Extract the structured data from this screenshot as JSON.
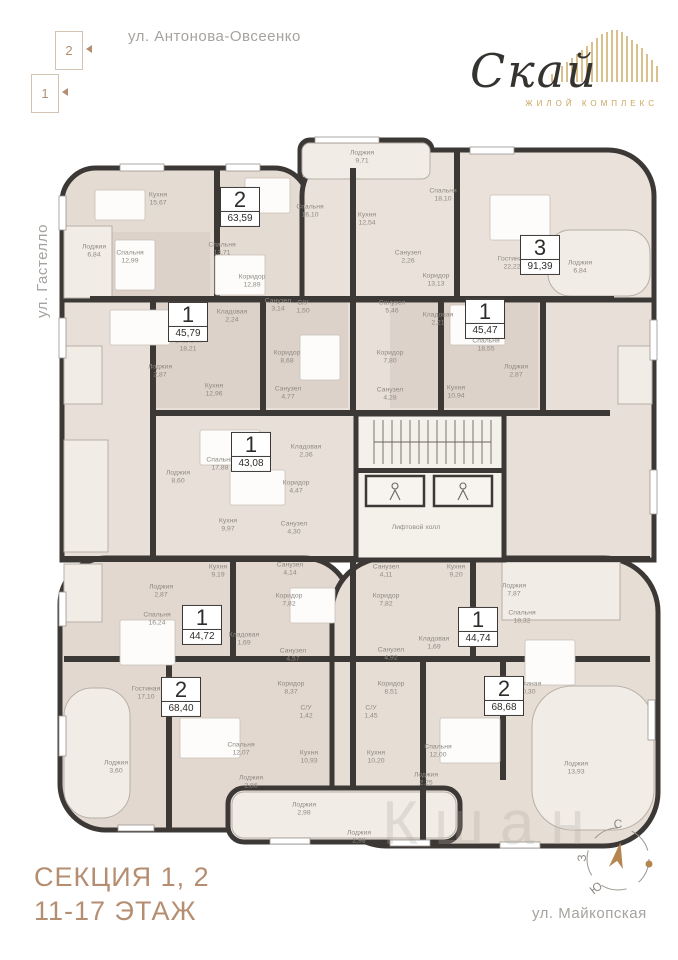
{
  "streets": {
    "top": "ул. Антонова-Овсеенко",
    "left": "ул. Гастелло",
    "right": "ул. Советской Армии",
    "bottom": "ул. Майкопская"
  },
  "section_selector": {
    "items": [
      {
        "label": "2"
      },
      {
        "label": "1"
      }
    ]
  },
  "logo": {
    "name": "Скай",
    "subtitle": "ЖИЛОЙ КОМПЛЕКС"
  },
  "footer": {
    "line1": "СЕКЦИЯ 1, 2",
    "line2": "11-17 ЭТАЖ"
  },
  "compass": {
    "north": "С",
    "south": "Ю",
    "west": "З"
  },
  "watermark": {
    "text": "Кшан"
  },
  "floor_plan": {
    "apartments": [
      {
        "rooms": "2",
        "area": "63,59",
        "x": 240,
        "y": 207
      },
      {
        "rooms": "3",
        "area": "91,39",
        "x": 540,
        "y": 255
      },
      {
        "rooms": "1",
        "area": "45,79",
        "x": 188,
        "y": 322
      },
      {
        "rooms": "1",
        "area": "45,47",
        "x": 485,
        "y": 319
      },
      {
        "rooms": "1",
        "area": "43,08",
        "x": 251,
        "y": 452
      },
      {
        "rooms": "1",
        "area": "44,72",
        "x": 202,
        "y": 625
      },
      {
        "rooms": "1",
        "area": "44,74",
        "x": 478,
        "y": 627
      },
      {
        "rooms": "2",
        "area": "68,40",
        "x": 181,
        "y": 697
      },
      {
        "rooms": "2",
        "area": "68,68",
        "x": 504,
        "y": 696
      }
    ],
    "room_labels": [
      {
        "name": "Кухня",
        "area": "15,67",
        "x": 158,
        "y": 200
      },
      {
        "name": "Лоджия",
        "area": "6,84",
        "x": 94,
        "y": 252
      },
      {
        "name": "Спальня",
        "area": "12,99",
        "x": 130,
        "y": 258
      },
      {
        "name": "Спальня",
        "area": "13,71",
        "x": 222,
        "y": 250
      },
      {
        "name": "Коридор",
        "area": "12,89",
        "x": 252,
        "y": 282
      },
      {
        "name": "Лоджия",
        "area": "9,71",
        "x": 362,
        "y": 158
      },
      {
        "name": "Спальня",
        "area": "16,10",
        "x": 310,
        "y": 212
      },
      {
        "name": "Кухня",
        "area": "12,54",
        "x": 367,
        "y": 220
      },
      {
        "name": "Спальня",
        "area": "18,10",
        "x": 443,
        "y": 196
      },
      {
        "name": "Санузел",
        "area": "2,26",
        "x": 408,
        "y": 258
      },
      {
        "name": "Коридор",
        "area": "13,13",
        "x": 436,
        "y": 281
      },
      {
        "name": "Гостиная",
        "area": "22,22",
        "x": 512,
        "y": 264
      },
      {
        "name": "Лоджия",
        "area": "6,84",
        "x": 580,
        "y": 268
      },
      {
        "name": "Санузел",
        "area": "5,46",
        "x": 392,
        "y": 308
      },
      {
        "name": "Спальня",
        "area": "18,21",
        "x": 188,
        "y": 346
      },
      {
        "name": "Кладовая",
        "area": "2,24",
        "x": 232,
        "y": 317
      },
      {
        "name": "Санузел",
        "area": "3,14",
        "x": 278,
        "y": 306
      },
      {
        "name": "С/У",
        "area": "1,50",
        "x": 303,
        "y": 308
      },
      {
        "name": "Коридор",
        "area": "8,68",
        "x": 287,
        "y": 358
      },
      {
        "name": "Лоджия",
        "area": "2,87",
        "x": 160,
        "y": 372
      },
      {
        "name": "Кухня",
        "area": "12,96",
        "x": 214,
        "y": 391
      },
      {
        "name": "Санузел",
        "area": "4,77",
        "x": 288,
        "y": 394
      },
      {
        "name": "Кладовая",
        "area": "2,21",
        "x": 438,
        "y": 320
      },
      {
        "name": "Спальня",
        "area": "18,55",
        "x": 486,
        "y": 346
      },
      {
        "name": "Коридор",
        "area": "7,80",
        "x": 390,
        "y": 358
      },
      {
        "name": "Лоджия",
        "area": "2,87",
        "x": 516,
        "y": 372
      },
      {
        "name": "Кухня",
        "area": "10,94",
        "x": 456,
        "y": 393
      },
      {
        "name": "Санузел",
        "area": "4,28",
        "x": 390,
        "y": 395
      },
      {
        "name": "Спальня",
        "area": "17,88",
        "x": 220,
        "y": 465
      },
      {
        "name": "Кладовая",
        "area": "2,36",
        "x": 306,
        "y": 452
      },
      {
        "name": "Лоджия",
        "area": "8,60",
        "x": 178,
        "y": 478
      },
      {
        "name": "Коридор",
        "area": "4,47",
        "x": 296,
        "y": 488
      },
      {
        "name": "Кухня",
        "area": "9,97",
        "x": 228,
        "y": 526
      },
      {
        "name": "Санузел",
        "area": "4,30",
        "x": 294,
        "y": 529
      },
      {
        "name": "Лифтовой холл",
        "area": "",
        "x": 416,
        "y": 528
      },
      {
        "name": "Кухня",
        "area": "9,19",
        "x": 218,
        "y": 572
      },
      {
        "name": "Санузел",
        "area": "4,14",
        "x": 290,
        "y": 570
      },
      {
        "name": "Лоджия",
        "area": "2,87",
        "x": 161,
        "y": 592
      },
      {
        "name": "Спальня",
        "area": "16,24",
        "x": 157,
        "y": 620
      },
      {
        "name": "Коридор",
        "area": "7,82",
        "x": 289,
        "y": 601
      },
      {
        "name": "Кладовая",
        "area": "1,69",
        "x": 244,
        "y": 640
      },
      {
        "name": "Санузел",
        "area": "4,57",
        "x": 293,
        "y": 656
      },
      {
        "name": "Санузел",
        "area": "4,11",
        "x": 386,
        "y": 572
      },
      {
        "name": "Кухня",
        "area": "9,20",
        "x": 456,
        "y": 572
      },
      {
        "name": "Коридор",
        "area": "7,82",
        "x": 386,
        "y": 601
      },
      {
        "name": "Лоджия",
        "area": "7,87",
        "x": 514,
        "y": 591
      },
      {
        "name": "Спальня",
        "area": "18,32",
        "x": 522,
        "y": 618
      },
      {
        "name": "Кладовая",
        "area": "1,69",
        "x": 434,
        "y": 644
      },
      {
        "name": "Санузел",
        "area": "4,92",
        "x": 391,
        "y": 655
      },
      {
        "name": "Гостиная",
        "area": "17,10",
        "x": 146,
        "y": 694
      },
      {
        "name": "Лоджия",
        "area": "3,60",
        "x": 116,
        "y": 768
      },
      {
        "name": "Спальня",
        "area": "12,07",
        "x": 241,
        "y": 750
      },
      {
        "name": "Коридор",
        "area": "8,37",
        "x": 291,
        "y": 689
      },
      {
        "name": "С/У",
        "area": "1,42",
        "x": 306,
        "y": 713
      },
      {
        "name": "Кухня",
        "area": "10,93",
        "x": 309,
        "y": 758
      },
      {
        "name": "Лоджия",
        "area": "2,86",
        "x": 251,
        "y": 783
      },
      {
        "name": "Лоджия",
        "area": "2,98",
        "x": 304,
        "y": 810
      },
      {
        "name": "Коридор",
        "area": "8,51",
        "x": 391,
        "y": 689
      },
      {
        "name": "С/У",
        "area": "1,45",
        "x": 371,
        "y": 713
      },
      {
        "name": "Гостиная",
        "area": "20,30",
        "x": 527,
        "y": 689
      },
      {
        "name": "Спальня",
        "area": "12,00",
        "x": 438,
        "y": 752
      },
      {
        "name": "Кухня",
        "area": "10,20",
        "x": 376,
        "y": 758
      },
      {
        "name": "Лоджия",
        "area": "2,25",
        "x": 426,
        "y": 780
      },
      {
        "name": "Лоджия",
        "area": "13,93",
        "x": 576,
        "y": 769
      },
      {
        "name": "Лоджия",
        "area": "2,98",
        "x": 359,
        "y": 838
      }
    ]
  }
}
